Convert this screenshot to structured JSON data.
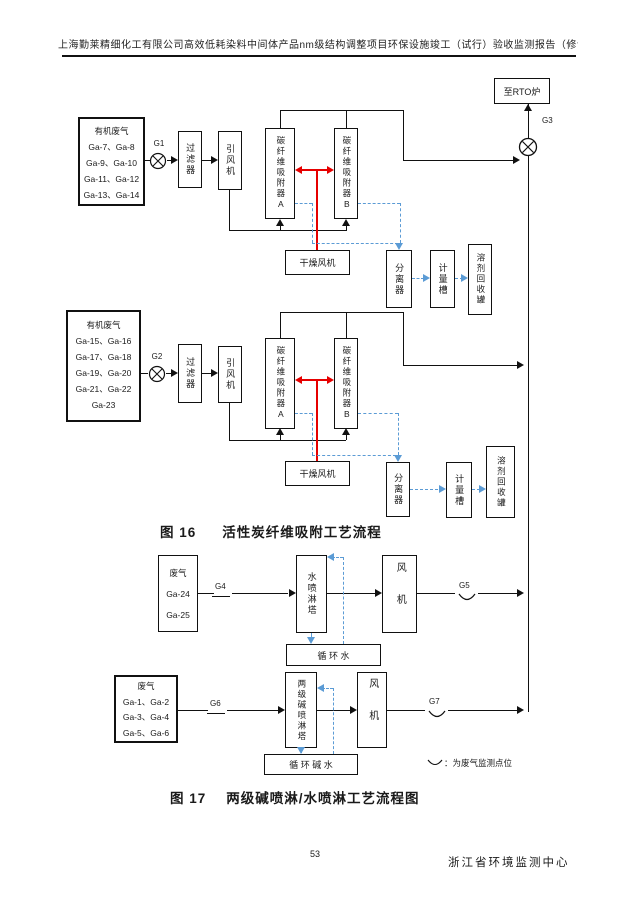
{
  "page": {
    "header_title": "上海勤莱精细化工有限公司高效低耗染料中间体产品nm级结构调整项目环保设施竣工（试行）验收监测报告（修订版）",
    "page_number": "53",
    "footer_org": "浙江省环境监测中心"
  },
  "colors": {
    "line_red": "#e60000",
    "line_blue": "#5b9bd5",
    "ink": "#1a1a1a"
  },
  "fig16": {
    "caption_no": "图 16",
    "caption": "活性炭纤维吸附工艺流程",
    "rto_label": "至RTO炉",
    "g3": "G3",
    "train1": {
      "source_title": "有机废气",
      "sources": [
        "Ga-7、Ga-8",
        "Ga-9、Ga-10",
        "Ga-11、Ga-12",
        "Ga-13、Ga-14"
      ],
      "blower": "G1",
      "filter": "过滤器",
      "draft_fan": "引风机",
      "adsorber_a": "碳纤维吸附器A",
      "adsorber_b": "碳纤维吸附器B",
      "drying_fan": "干燥风机",
      "separator": "分离器",
      "measuring_tank": "计量槽",
      "recovery_tank": "溶剂回收罐"
    },
    "train2": {
      "source_title": "有机废气",
      "sources": [
        "Ga-15、Ga-16",
        "Ga-17、Ga-18",
        "Ga-19、Ga-20",
        "Ga-21、Ga-22",
        "Ga-23"
      ],
      "blower": "G2",
      "filter": "过滤器",
      "draft_fan": "引风机",
      "adsorber_a": "碳纤维吸附器A",
      "adsorber_b": "碳纤维吸附器B",
      "drying_fan": "干燥风机",
      "separator": "分离器",
      "measuring_tank": "计量槽",
      "recovery_tank": "溶剂回收罐"
    }
  },
  "fig17": {
    "caption_no": "图 17",
    "caption": "两级碱喷淋/水喷淋工艺流程图",
    "water_train": {
      "source_title": "废气",
      "sources": [
        "Ga-24",
        "Ga-25"
      ],
      "inlet_point": "G4",
      "tower": "水喷淋塔",
      "fan": "风机",
      "outlet_point": "G5",
      "recycle": "循 环 水"
    },
    "alkali_train": {
      "source_title": "废气",
      "sources": [
        "Ga-1、Ga-2",
        "Ga-3、Ga-4",
        "Ga-5、Ga-6"
      ],
      "inlet_point": "G6",
      "tower": "两级碱喷淋塔",
      "fan": "风机",
      "outlet_point": "G7",
      "recycle": "循 环 碱 水"
    },
    "legend": "：为废气监测点位"
  }
}
